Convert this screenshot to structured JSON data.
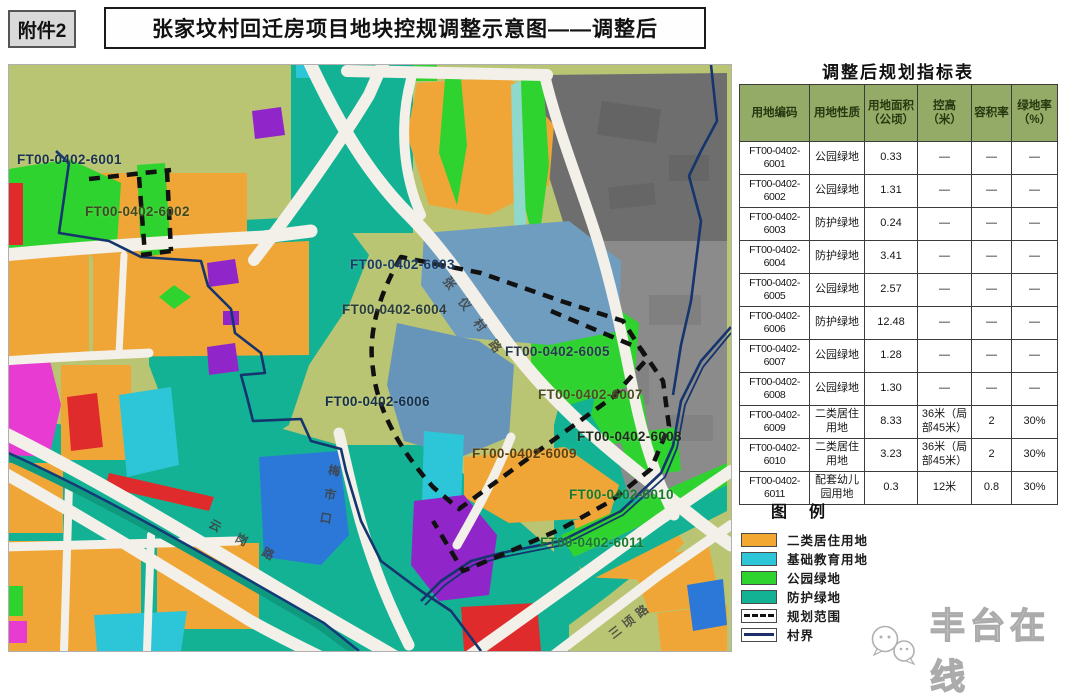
{
  "page": {
    "attachment_badge": "附件2",
    "title": "张家坟村回迁房项目地块控规调整示意图——调整后"
  },
  "table": {
    "title": "调整后规划指标表",
    "columns": [
      "用地编码",
      "用地性质",
      "用地面积（公顷）",
      "控高（米）",
      "容积率",
      "绿地率（%）"
    ],
    "rows": [
      {
        "code": "FT00-0402-6001",
        "nature": "公园绿地",
        "area": "0.33",
        "height": "—",
        "far": "—",
        "green": "—"
      },
      {
        "code": "FT00-0402-6002",
        "nature": "公园绿地",
        "area": "1.31",
        "height": "—",
        "far": "—",
        "green": "—"
      },
      {
        "code": "FT00-0402-6003",
        "nature": "防护绿地",
        "area": "0.24",
        "height": "—",
        "far": "—",
        "green": "—"
      },
      {
        "code": "FT00-0402-6004",
        "nature": "防护绿地",
        "area": "3.41",
        "height": "—",
        "far": "—",
        "green": "—"
      },
      {
        "code": "FT00-0402-6005",
        "nature": "公园绿地",
        "area": "2.57",
        "height": "—",
        "far": "—",
        "green": "—"
      },
      {
        "code": "FT00-0402-6006",
        "nature": "防护绿地",
        "area": "12.48",
        "height": "—",
        "far": "—",
        "green": "—"
      },
      {
        "code": "FT00-0402-6007",
        "nature": "公园绿地",
        "area": "1.28",
        "height": "—",
        "far": "—",
        "green": "—"
      },
      {
        "code": "FT00-0402-6008",
        "nature": "公园绿地",
        "area": "1.30",
        "height": "—",
        "far": "—",
        "green": "—"
      },
      {
        "code": "FT00-0402-6009",
        "nature": "二类居住用地",
        "area": "8.33",
        "height": "36米（局部45米）",
        "far": "2",
        "green": "30%"
      },
      {
        "code": "FT00-0402-6010",
        "nature": "二类居住用地",
        "area": "3.23",
        "height": "36米（局部45米）",
        "far": "2",
        "green": "30%"
      },
      {
        "code": "FT00-0402-6011",
        "nature": "配套幼儿园用地",
        "area": "0.3",
        "height": "12米",
        "far": "0.8",
        "green": "30%"
      }
    ]
  },
  "legend": {
    "title": "图例",
    "items": [
      {
        "label": "二类居住用地",
        "type": "fill",
        "color": "#f3a832"
      },
      {
        "label": "基础教育用地",
        "type": "fill",
        "color": "#2cc6d8"
      },
      {
        "label": "公园绿地",
        "type": "fill",
        "color": "#2fd32f"
      },
      {
        "label": "防护绿地",
        "type": "fill",
        "color": "#14b294"
      },
      {
        "label": "规划范围",
        "type": "dashed",
        "color": "#111111"
      },
      {
        "label": "村界",
        "type": "line",
        "color": "#1c2f6b"
      }
    ]
  },
  "map": {
    "plot_labels": [
      {
        "text": "FT00-0402-6001",
        "x": 16,
        "y": 151,
        "color": "#1b3350"
      },
      {
        "text": "FT00-0402-6002",
        "x": 84,
        "y": 203,
        "color": "#3c4a1f"
      },
      {
        "text": "FT00-0402-6003",
        "x": 349,
        "y": 256,
        "color": "#1a3c66"
      },
      {
        "text": "FT00-0402-6004",
        "x": 341,
        "y": 301,
        "color": "#2a3d3c"
      },
      {
        "text": "FT00-0402-6005",
        "x": 504,
        "y": 343,
        "color": "#263a4e"
      },
      {
        "text": "FT00-0402-6006",
        "x": 324,
        "y": 393,
        "color": "#16304a"
      },
      {
        "text": "FT00-0402-6007",
        "x": 537,
        "y": 386,
        "color": "#4a4e20"
      },
      {
        "text": "FT00-0402-6008",
        "x": 576,
        "y": 428,
        "color": "#1e2a1a"
      },
      {
        "text": "FT00-0402-6009",
        "x": 471,
        "y": 445,
        "color": "#5c430c"
      },
      {
        "text": "FT00-0402-6010",
        "x": 568,
        "y": 486,
        "color": "#177a2e"
      },
      {
        "text": "FT00-0402-6011",
        "x": 539,
        "y": 534,
        "color": "#177a2e"
      }
    ],
    "road_labels": [
      {
        "text": "张仪村路",
        "x": 452,
        "y": 272,
        "rotate": 54,
        "spacing": 14
      },
      {
        "text": "梅市口",
        "x": 326,
        "y": 462,
        "rotate": 10,
        "spacing": 12,
        "vertical": true
      },
      {
        "text": "云岗路",
        "x": 213,
        "y": 514,
        "rotate": 28,
        "spacing": 18
      },
      {
        "text": "三顷路",
        "x": 604,
        "y": 628,
        "rotate": -38,
        "spacing": 5
      }
    ]
  },
  "watermark": {
    "text": "丰台在线",
    "icon": "wechat-bubbles-icon"
  }
}
